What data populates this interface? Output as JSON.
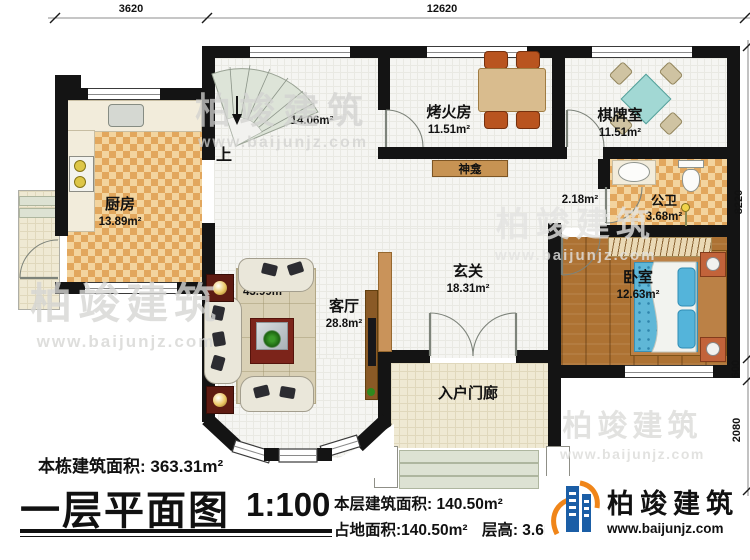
{
  "dimensions": {
    "top": [
      "3620",
      "12620"
    ],
    "right": [
      "8220",
      "600",
      "2080"
    ]
  },
  "rooms": {
    "stairwell": {
      "area": "14.06m²",
      "up": "上"
    },
    "kitchen": {
      "name": "厨房",
      "area": "13.89m²"
    },
    "fire_room": {
      "name": "烤火房",
      "area": "11.51m²"
    },
    "chess_room": {
      "name": "棋牌室",
      "area": "11.51m²"
    },
    "shrine": {
      "name": "神龛"
    },
    "corridor": {
      "area": "2.18m²"
    },
    "bathroom": {
      "name": "公卫",
      "area": "3.68m²"
    },
    "bedroom": {
      "name": "卧室",
      "area": "12.63m²"
    },
    "foyer": {
      "name": "玄关",
      "area": "18.31m²"
    },
    "living_room": {
      "name": "客厅",
      "area": "28.8m²",
      "area_alt": "43.99m²"
    },
    "porch": {
      "name": "入户门廊"
    }
  },
  "title_block": {
    "total_area": "本栋建筑面积: 363.31m²",
    "plan_title": "一层平面图",
    "scale": "1:100",
    "floor_area": "本层建筑面积: 140.50m²",
    "ground_area": "占地面积:140.50m²",
    "floor_height": "层高: 3.6m"
  },
  "brand": {
    "name": "柏竣建筑",
    "website": "www.baijunjz.com"
  },
  "watermark": {
    "name": "柏竣建筑",
    "website": "www.baijunjz.com"
  },
  "colors": {
    "wall": "#141414",
    "accent_blue": "#1b5ea6",
    "accent_orange": "#f08519",
    "bed_blue": "#5fb7d7",
    "kitchen_check": "#e2a75d",
    "wood": "#ad7233",
    "chess_table_teal": "#a2d8d4",
    "shrine_brown": "#c79353"
  }
}
